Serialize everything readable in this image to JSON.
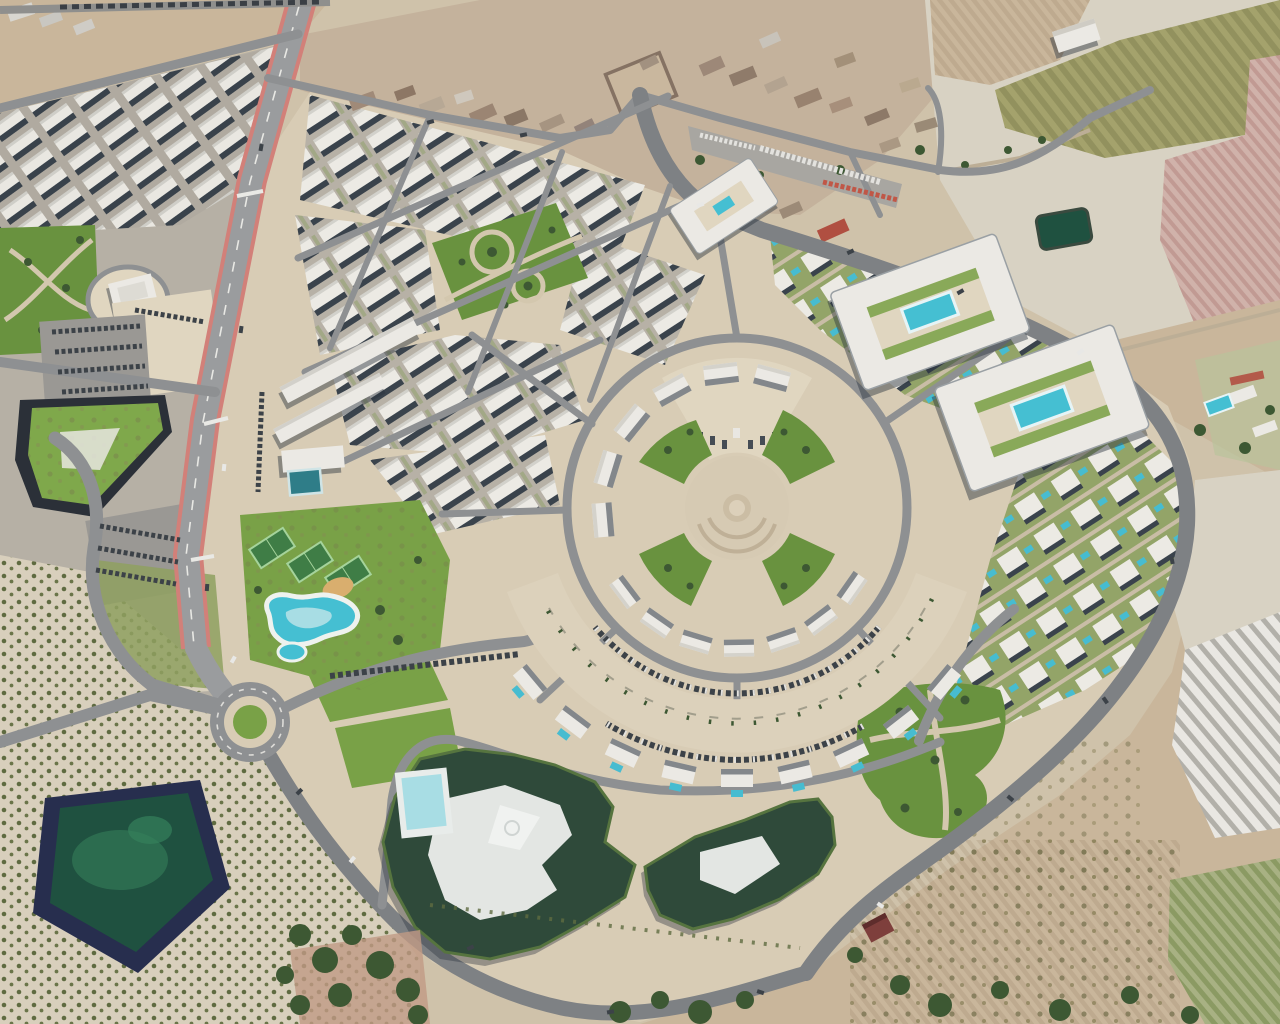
{
  "scene": {
    "type": "aerial-satellite-render",
    "description": "Aerial 3D render of a new-build resort masterplan with a circular central plaza, set beside an existing village and surrounded by olive orchards, tilled fields, greenhouses and an irrigation pond",
    "orientation": "oblique top-down, shadows cast toward south-west"
  },
  "palette": {
    "base_tan": "#cfc2aa",
    "dev_sand": "#d8ccb5",
    "sand_light": "#e0d6c0",
    "esplanade": "#dcd1bb",
    "urban_ground": "#b6b0a5",
    "road": "#8e9092",
    "road_dark": "#7e8184",
    "highway": "#9a9c9e",
    "red_edge": "#d28079",
    "building_white": "#ebe9e4",
    "shadow_dark": "#3a434c",
    "dark_roof": "#2f4a3a",
    "hedge_green": "#56743f",
    "lawn": "#79a147",
    "park": "#69923f",
    "court": "#3f7d46",
    "tree": "#3d5833",
    "pool": "#45bfd2",
    "pool_deep": "#2f7d88",
    "pool_light": "#a8dde4",
    "pond_rim": "#272e4e",
    "pond_water": "#1f5140",
    "pond_algae": "#2f7352",
    "field_tan": "#c9b69b",
    "field_pale": "#d8d2c3",
    "field_olive": "#a4a26c",
    "field_pink": "#ccada5",
    "village_ground": "#c4b29c",
    "truck_red": "#c05747",
    "car_dark": "#3c4248"
  },
  "features": [
    {
      "id": "main-highway",
      "note": "wide road with reddish edge stripes running from top edge down to a roundabout"
    },
    {
      "id": "roundabout",
      "note": "grass-centred roundabout at lower left of the development"
    },
    {
      "id": "central-plaza",
      "note": "circular paved plaza with concentric arcs and four green wedge gardens"
    },
    {
      "id": "fan-villas",
      "note": "fan of detached villas ringing the plaza on its north-west side"
    },
    {
      "id": "row-houses",
      "note": "curved arc of row houses south of the plaza"
    },
    {
      "id": "outer-villa-arc",
      "note": "outer arc of villas with private pools"
    },
    {
      "id": "esplanade",
      "note": "palm-lined crescent esplanade with parking arcs"
    },
    {
      "id": "apartment-block-pool-a",
      "note": "rectangular courtyard apartment block with turquoise pool"
    },
    {
      "id": "apartment-block-pool-b",
      "note": "second courtyard apartment block with turquoise pool"
    },
    {
      "id": "south-complex",
      "note": "irregular dark-green-roofed hotel/apartment complex with white courtyard and pool"
    },
    {
      "id": "lagoon-pool",
      "note": "free-form lagoon swimming pool with white sand rim"
    },
    {
      "id": "sports-courts",
      "note": "three green racquet courts in a garden zone"
    },
    {
      "id": "green-roof-commercial",
      "note": "triangular grass-roofed commercial building west of the highway"
    },
    {
      "id": "townhouse-district-nw",
      "note": "diagonal rows of white townhouses around a square park"
    },
    {
      "id": "left-townhouse-district",
      "note": "existing rows of white townhouses west of the highway"
    },
    {
      "id": "village",
      "note": "existing village with brown-roofed houses, walled yard and truck depot"
    },
    {
      "id": "irrigation-pond",
      "note": "trapezoidal dark-rimmed irrigation pond with green water"
    },
    {
      "id": "olive-orchard",
      "note": "grids of olive trees on pale soil, lower left"
    },
    {
      "id": "greenhouses",
      "note": "white striped greenhouse roofs, lower right"
    },
    {
      "id": "farm-fields",
      "note": "tan, olive and pink tilled fields with a farm building and dark pond, upper right"
    }
  ]
}
